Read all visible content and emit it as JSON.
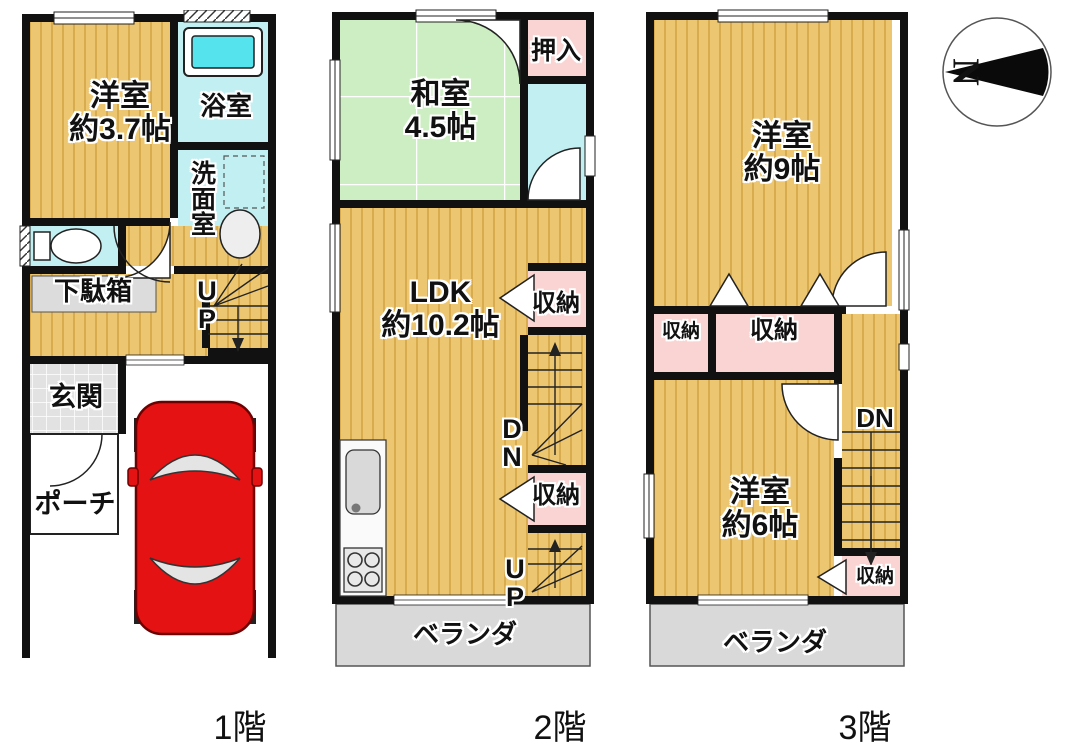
{
  "compass": {
    "north": "N"
  },
  "f1": {
    "label": "1階",
    "yoshitsu_name": "洋室",
    "yoshitsu_size": "約3.7帖",
    "bath": "浴室",
    "wash": "洗面室",
    "getabako": "下駄箱",
    "up": "UP",
    "genkan": "玄関",
    "porch": "ポーチ"
  },
  "f2": {
    "label": "2階",
    "washitsu_name": "和室",
    "washitsu_size": "4.5帖",
    "oshiire": "押入",
    "ldk_name": "LDK",
    "ldk_size": "約10.2帖",
    "storage1": "収納",
    "dn": "DN",
    "storage2": "収納",
    "up": "UP",
    "veranda": "ベランダ"
  },
  "f3": {
    "label": "3階",
    "room9_name": "洋室",
    "room9_size": "約9帖",
    "storage_small": "収納",
    "storage_mid": "収納",
    "dn": "DN",
    "room6_name": "洋室",
    "room6_size": "約6帖",
    "storage_low": "収納",
    "veranda": "ベランダ"
  },
  "colors": {
    "wood": "#ecc670",
    "wood_stripe": "#d8ab4e",
    "tatami": "#cdeec2",
    "water_cyan": "#c2f0f2",
    "tub_cyan": "#55e3ee",
    "storage_pink": "#f9d4d2",
    "veranda_gray": "#d9d9d9",
    "tile_gray": "#e2e2e2",
    "wall_black": "#111111",
    "car_red": "#e41212"
  }
}
